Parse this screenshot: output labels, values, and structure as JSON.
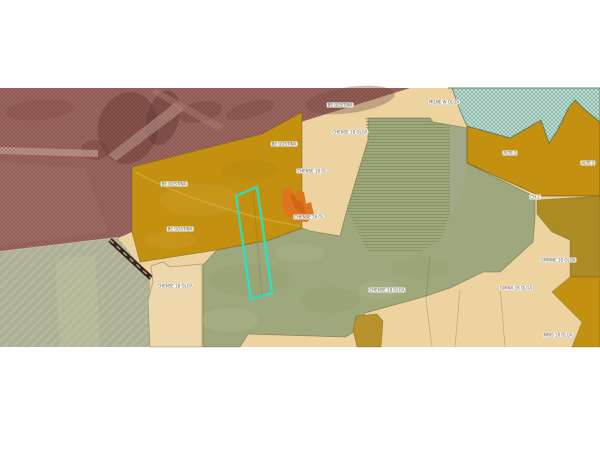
{
  "page": {
    "background": "#ffffff"
  },
  "map": {
    "palette": {
      "tan": "#ecd3a0",
      "tan_light": "#eed7ab",
      "ochre": "#c3900f",
      "ochre_dark": "#ad8b24",
      "ochre_olive": "#b8922a",
      "sage": "#9fa87c",
      "fields_gray": "#adb095",
      "gray_strip": "#a2a88a",
      "aerial_red": "#9c6a62",
      "teal_hatch": "#c3e1d6",
      "orange_marker": "#e0731e",
      "selection_cyan": "#22e5c5",
      "railway_dark": "#33251f"
    },
    "selected_parcel": {
      "outline_color": "#22e5c5"
    },
    "labels": [
      {
        "text": "BE GOSTINA",
        "x": 340,
        "y": 105
      },
      {
        "text": "MILNE W OLGA",
        "x": 444,
        "y": 102
      },
      {
        "text": "CHENSE 18 OLGA",
        "x": 350,
        "y": 132
      },
      {
        "text": "BE GOSTINA",
        "x": 284,
        "y": 144
      },
      {
        "text": "ALTE 2",
        "x": 510,
        "y": 153
      },
      {
        "text": "ALTE 2",
        "x": 588,
        "y": 163
      },
      {
        "text": "CHENSE 18 OL",
        "x": 312,
        "y": 171
      },
      {
        "text": "BE GOSTINA",
        "x": 174,
        "y": 184
      },
      {
        "text": "CH 2",
        "x": 535,
        "y": 197
      },
      {
        "text": "CHENSE 18 OL",
        "x": 309,
        "y": 217
      },
      {
        "text": "BE GOSTINA",
        "x": 180,
        "y": 229
      },
      {
        "text": "GMINNE 18 OLGA",
        "x": 558,
        "y": 260
      },
      {
        "text": "CHENSE 18 OLGA",
        "x": 175,
        "y": 286
      },
      {
        "text": "CHENSE 18 OLGA",
        "x": 387,
        "y": 290
      },
      {
        "text": "GMINA 18 OLGA",
        "x": 516,
        "y": 288
      },
      {
        "text": "MINS 18 OLGA",
        "x": 558,
        "y": 335
      }
    ]
  }
}
